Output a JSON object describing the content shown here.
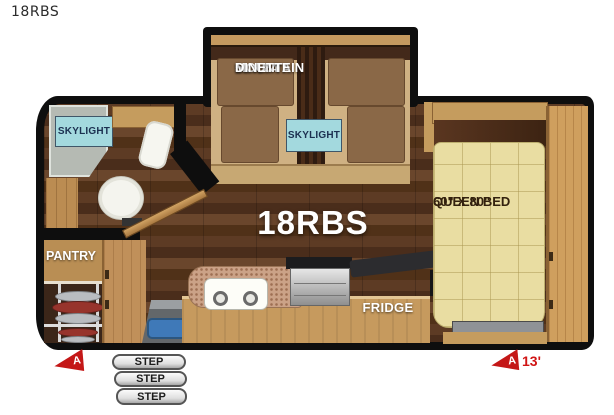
{
  "title_label": "18RBS",
  "floorplan": {
    "center_label": "18RBS",
    "dinette": {
      "size_line": "51 x 84",
      "name_line1": "MOUNTAIN",
      "name_line2": "DINETTE",
      "skylight": "SKYLIGHT"
    },
    "bathroom": {
      "skylight": "SKYLIGHT"
    },
    "pantry": {
      "label": "PANTRY"
    },
    "kitchen": {
      "fridge": "FRIDGE"
    },
    "bedroom": {
      "size_line": "60\" X 80\"",
      "name_line": "QUEEN BED"
    },
    "steps": [
      "STEP",
      "STEP",
      "STEP"
    ],
    "markers": {
      "left": {
        "label": "A"
      },
      "right": {
        "label": "A",
        "length": "13'"
      }
    },
    "colors": {
      "wall": "#0e0e0e",
      "floor_dark": "#553722",
      "cabinet_wood": "#c69a5e",
      "cushion_brown": "#8a6847",
      "dinette_tan": "#cfb183",
      "mattress": "#e9dda2",
      "skylight_blue": "#a3d9de",
      "granite_counter": "#cba287",
      "marker_red": "#c41717",
      "step_gray": "#ededed",
      "label_white": "#ffffff"
    }
  }
}
